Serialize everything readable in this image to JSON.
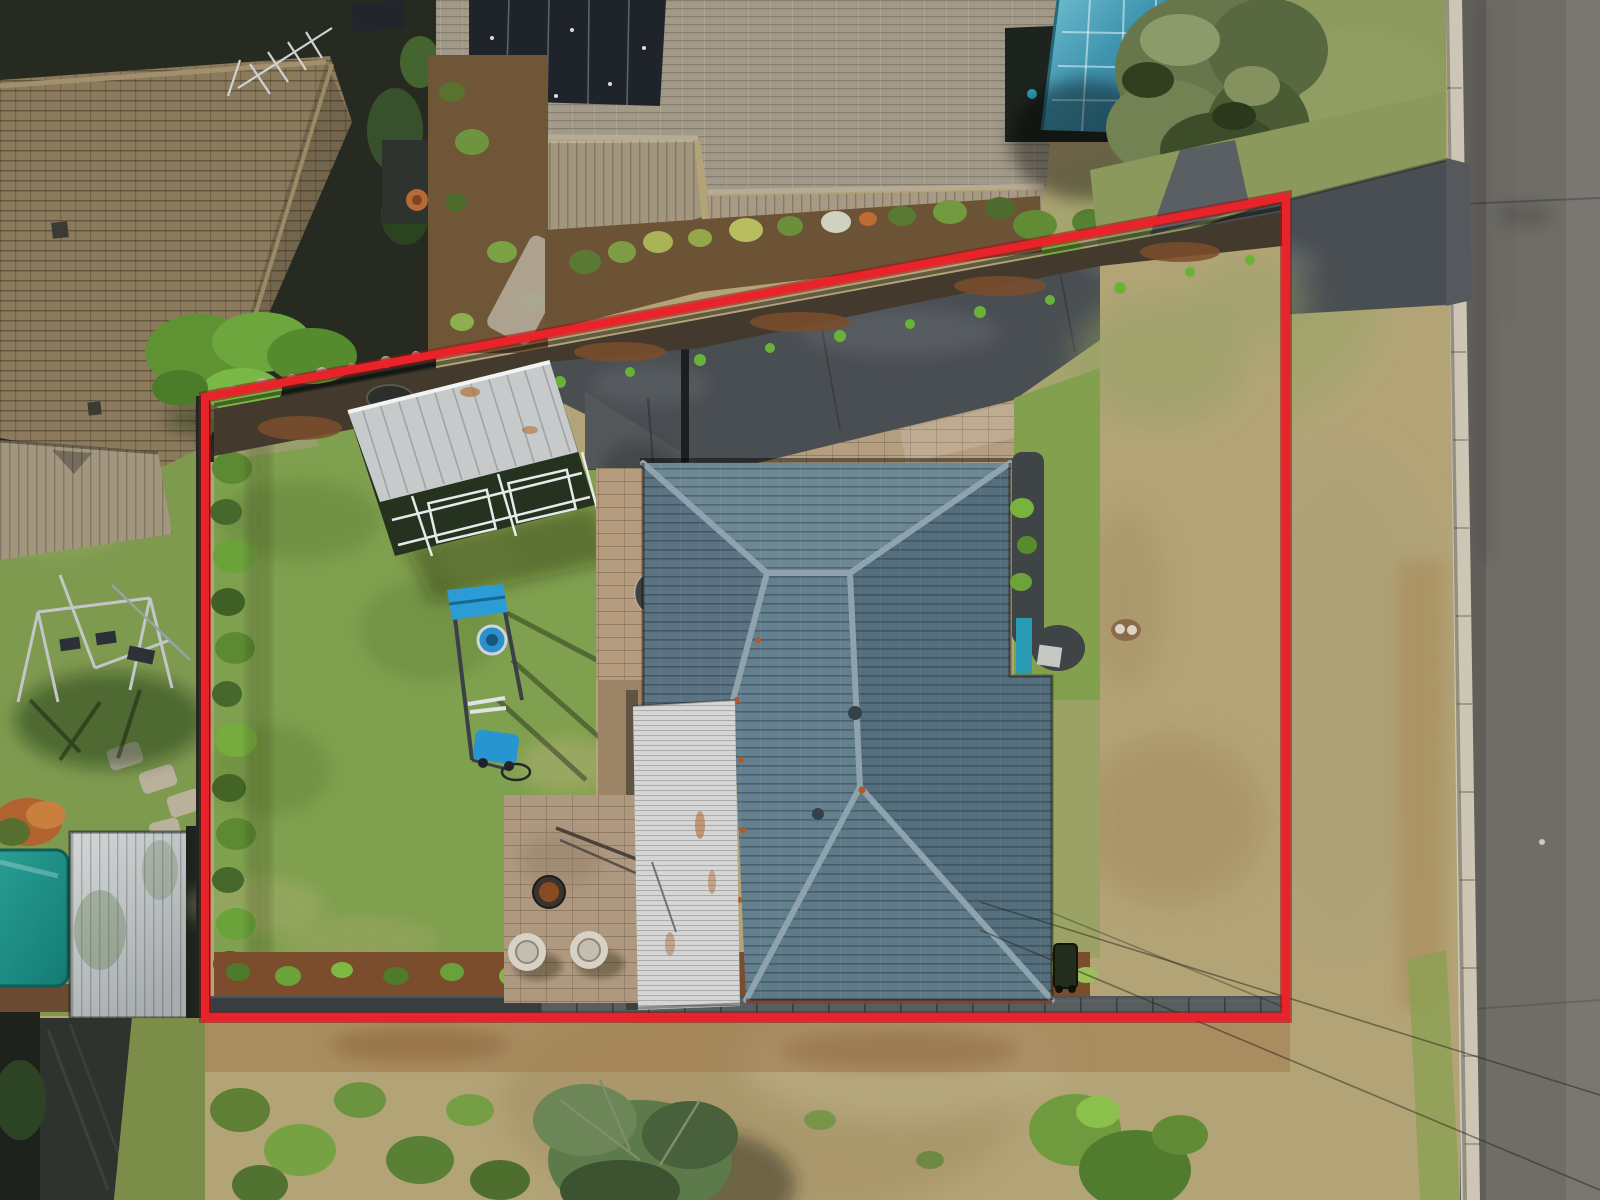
{
  "meta": {
    "title": "Aerial drone photograph of a residential property, top-down view",
    "type": "photograph",
    "overlay_purpose": "real-estate property boundary highlight"
  },
  "overlay": {
    "name": "property-boundary",
    "shape": "quadrilateral",
    "stroke_width": 8,
    "color": "#e8232a",
    "outline_color": "#9e1216"
  },
  "palette": {
    "boundary_red": "#e8232a",
    "lawn_green": "#7fa04e",
    "lawn_green_dark": "#5d7c36",
    "dry_grass": "#b3a477",
    "dry_grass_green": "#9aa468",
    "road_asphalt": "#6f6d67",
    "kerb_concrete": "#cdc6b5",
    "driveway_asphalt": "#494e53",
    "concrete_slab": "#54585a",
    "paver_tan": "#b49e80",
    "patio_paver": "#ae9880",
    "house_tile": "#5e7482",
    "house_tile_light": "#6d8795",
    "house_tile_dark": "#556e7d",
    "ridge_cap": "#8fa3ae",
    "pergola_white": "#d6d7d5",
    "shed_silver": "#c6cacb",
    "turf_dark": "#24321f",
    "neighbour_tile_brown": "#8b7a5c",
    "neighbour_tile_taupe": "#a29a89",
    "metal_roof_tan": "#a3967e",
    "solar_panel": "#1f242b",
    "pool_enclosure_teal": "#4294ab",
    "pool_cover_teal": "#21968a",
    "mulch_brown": "#7b4d2c",
    "soil_dark": "#433a2d",
    "hedge_green": "#47682c",
    "bush_green": "#6e9940",
    "tree_sage": "#67774b",
    "fence_dark": "#383d3f",
    "equipment_blue": "#2b9cd6"
  },
  "scene": {
    "subject_property": {
      "label": "outlined property",
      "features": [
        "hip-roof house",
        "white patio roof",
        "carport shed",
        "green back lawn",
        "fire-pit patio with two chairs",
        "blue play equipment",
        "boundary hedge",
        "mulch garden beds",
        "compost bin",
        "asphalt driveway",
        "brick paver apron",
        "dry front lawn",
        "satellite dish",
        "wheelie bin",
        "manhole cover"
      ]
    },
    "surroundings": {
      "label": "neighbouring properties and street",
      "features": [
        "brown tile roof with TV antenna",
        "taupe tile roof with solar panels",
        "tan metal roofs",
        "teal pool enclosure",
        "large sage tree",
        "swing set",
        "teal pool cover",
        "grey garden shed",
        "street with concrete kerb",
        "dry nature strip",
        "overhead power lines",
        "scrub and small trees along rear"
      ]
    }
  }
}
